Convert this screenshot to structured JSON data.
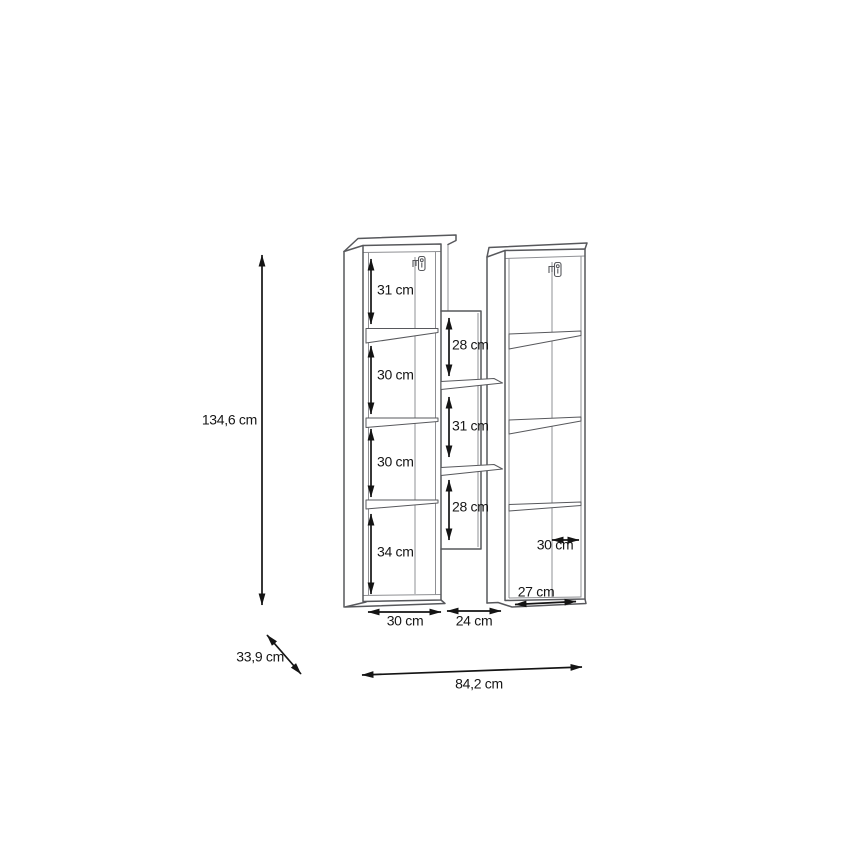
{
  "title": "furniture dimension drawing",
  "colors": {
    "structure": "#57585c",
    "structure_light": "#8f9094",
    "dimension": "#141414",
    "text": "#161616",
    "background": "#ffffff"
  },
  "diagram": {
    "overall": {
      "height": "134,6 cm",
      "depth": "33,9 cm",
      "width": "84,2 cm"
    },
    "left_column": {
      "compartment_heights": [
        "31 cm",
        "30 cm",
        "30 cm",
        "34 cm"
      ],
      "width": "30 cm"
    },
    "middle_section": {
      "compartment_heights": [
        "28 cm",
        "31 cm",
        "28 cm"
      ],
      "width": "24 cm"
    },
    "right_column": {
      "depth": "30 cm",
      "bottom_width": "27 cm"
    }
  }
}
